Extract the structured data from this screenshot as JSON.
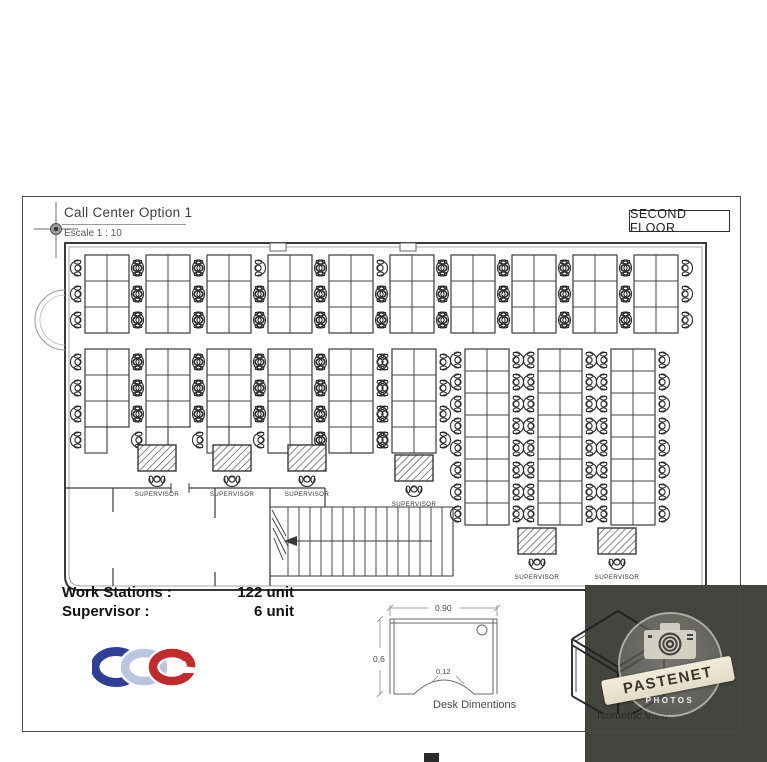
{
  "title_block": {
    "title": "Call Center Option 1",
    "scale": "Escale 1 : 10"
  },
  "floor_label": "SECOND FLOOR",
  "stats": {
    "rows": [
      {
        "label": "Work Stations :",
        "value": "122 unit"
      },
      {
        "label": "Supervisor :",
        "value": "6 unit"
      }
    ]
  },
  "logo": {
    "text": "CDC",
    "blue": "#2f3f98",
    "silver": "#b9c6de",
    "red": "#c22b2b"
  },
  "desk_dimensions": {
    "caption": "Desk Dimentions",
    "width": "0.90",
    "height": "0,6",
    "inset": "0,12"
  },
  "isometric": {
    "caption": "Isometric View"
  },
  "watermark": {
    "name": "PASTENET",
    "sub": "PHOTOS"
  },
  "plan": {
    "supervisor_label": "SUPERVISOR",
    "line_color": "#3a3a3a",
    "clusters": [
      {
        "x": 60,
        "y": 17,
        "cols": 2,
        "rows": 3,
        "rowH": 26
      },
      {
        "x": 121,
        "y": 17,
        "cols": 2,
        "rows": 3,
        "rowH": 26
      },
      {
        "x": 182,
        "y": 17,
        "cols": 2,
        "rows": 3,
        "rowH": 26
      },
      {
        "x": 243,
        "y": 17,
        "cols": 2,
        "rows": 3,
        "rowH": 26,
        "skip": [
          [
            0,
            0
          ]
        ]
      },
      {
        "x": 304,
        "y": 17,
        "cols": 2,
        "rows": 3,
        "rowH": 26
      },
      {
        "x": 365,
        "y": 17,
        "cols": 2,
        "rows": 3,
        "rowH": 26,
        "skip": [
          [
            0,
            0
          ]
        ]
      },
      {
        "x": 426,
        "y": 17,
        "cols": 2,
        "rows": 3,
        "rowH": 26
      },
      {
        "x": 487,
        "y": 17,
        "cols": 2,
        "rows": 3,
        "rowH": 26
      },
      {
        "x": 548,
        "y": 17,
        "cols": 2,
        "rows": 3,
        "rowH": 26
      },
      {
        "x": 609,
        "y": 17,
        "cols": 2,
        "rows": 3,
        "rowH": 26
      },
      {
        "x": 60,
        "y": 111,
        "cols": 2,
        "rows": 3,
        "rowH": 26,
        "extraLeft": true
      },
      {
        "x": 121,
        "y": 111,
        "cols": 2,
        "rows": 3,
        "rowH": 26,
        "extraLeft": true
      },
      {
        "x": 182,
        "y": 111,
        "cols": 2,
        "rows": 3,
        "rowH": 26,
        "extraLeft": true
      },
      {
        "x": 243,
        "y": 111,
        "cols": 2,
        "rows": 4,
        "rowH": 26
      },
      {
        "x": 304,
        "y": 111,
        "cols": 2,
        "rows": 4,
        "rowH": 26
      },
      {
        "x": 367,
        "y": 111,
        "cols": 2,
        "rows": 4,
        "rowH": 26
      },
      {
        "x": 440,
        "y": 111,
        "cols": 2,
        "rows": 8,
        "rowH": 22
      },
      {
        "x": 513,
        "y": 111,
        "cols": 2,
        "rows": 8,
        "rowH": 22
      },
      {
        "x": 586,
        "y": 111,
        "cols": 2,
        "rows": 8,
        "rowH": 22
      }
    ],
    "supervisors": [
      {
        "x": 113,
        "y": 207
      },
      {
        "x": 188,
        "y": 207
      },
      {
        "x": 263,
        "y": 207
      },
      {
        "x": 370,
        "y": 217
      },
      {
        "x": 493,
        "y": 290
      },
      {
        "x": 573,
        "y": 290
      }
    ]
  }
}
